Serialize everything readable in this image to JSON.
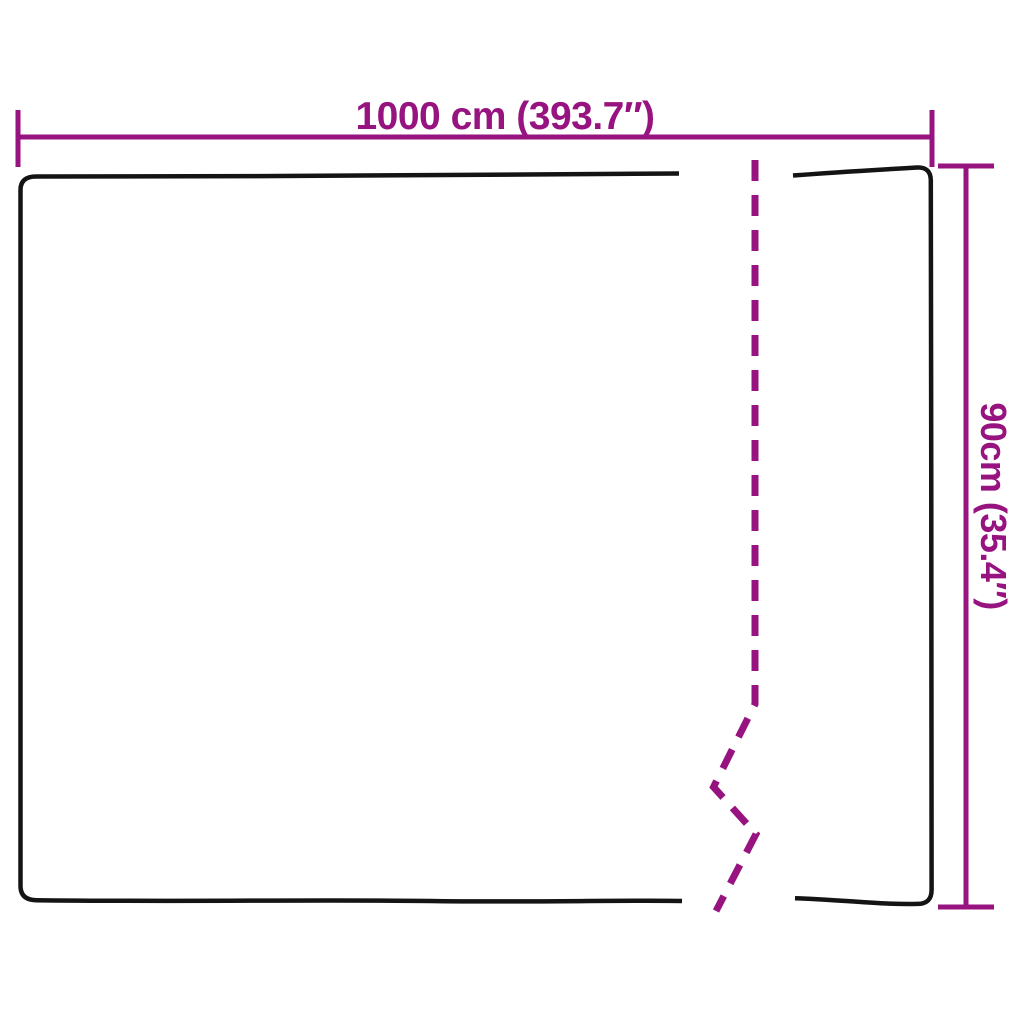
{
  "diagram": {
    "width_label": "1000 cm (393.7″)",
    "height_label": "90cm (35.4″)",
    "measurements": {
      "width_cm": 1000,
      "width_in": 393.7,
      "height_cm": 90,
      "height_in": 35.4
    },
    "colors": {
      "dimension_accent": "#97137F",
      "outline": "#141414",
      "background": "#FFFFFF"
    }
  }
}
